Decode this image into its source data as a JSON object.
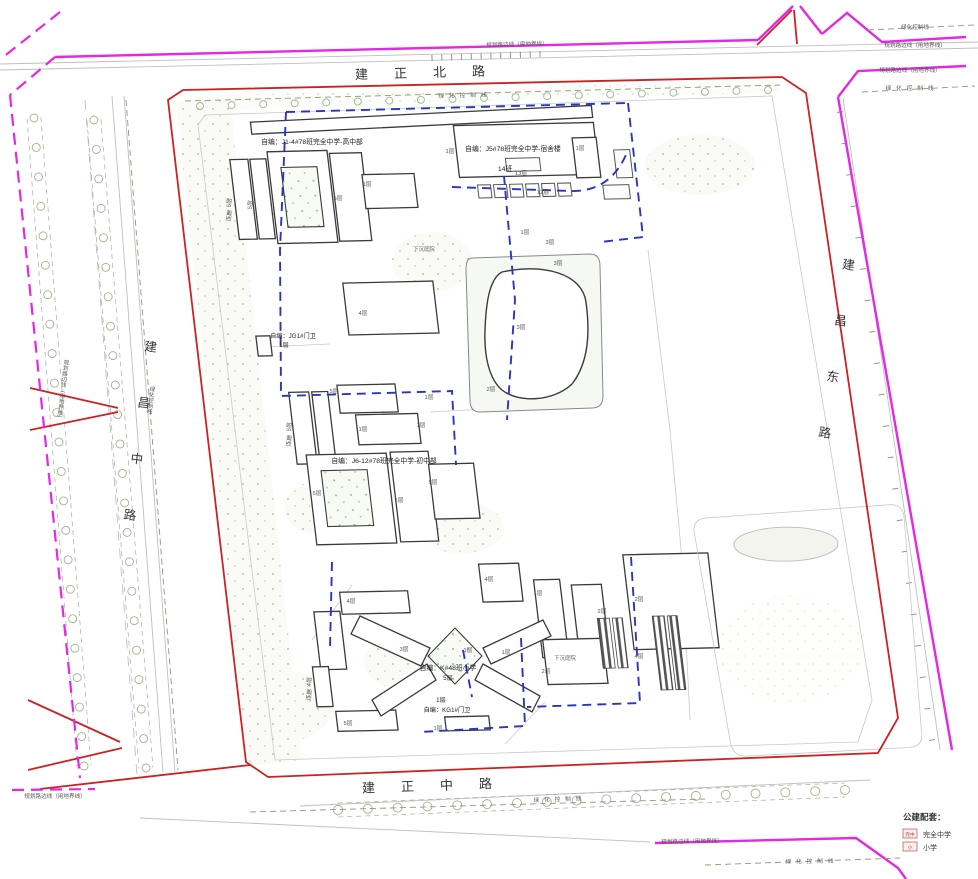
{
  "roads": {
    "north": "建正北路",
    "south": "建正中路",
    "west": "建昌中路",
    "east": "建昌东路"
  },
  "blocks": {
    "high_school": "自编：J1-4#78班完全中学-高中部",
    "dormitory": "自编：J5#78班完全中学-宿舍楼",
    "dormitory_classes": "14班",
    "gate_jg1": "自编：JG1#门卫",
    "gate_jg1_floors": "1层",
    "middle_school": "自编：J6-12#78班完全中学-初中部",
    "primary_school": "自编：K#48班小学",
    "primary_school_floors": "5层",
    "gate_kg1": "自编：KG1#门卫",
    "gate_kg1_floors": "1层",
    "sunken_courtyard": "下沉庭院"
  },
  "line_labels": {
    "planning_edge": "规划路边线（用地界线）",
    "green_control": "绿化控制线"
  },
  "legend": {
    "title": "公建配套：",
    "items": [
      {
        "icon": "完中",
        "label": "完全中学"
      },
      {
        "icon": "小",
        "label": "小学"
      }
    ]
  },
  "floor_tags": [
    {
      "label": "5层"
    },
    {
      "label": "连廊"
    },
    {
      "label": "5层"
    },
    {
      "label": "5层"
    },
    {
      "label": "1层"
    },
    {
      "label": "1层"
    },
    {
      "label": "1层"
    },
    {
      "label": "13层"
    },
    {
      "label": "12层"
    },
    {
      "label": "1层"
    },
    {
      "label": "3层"
    },
    {
      "label": "3层"
    },
    {
      "label": "3层"
    },
    {
      "label": "4层"
    },
    {
      "label": "1层"
    },
    {
      "label": "2层"
    },
    {
      "label": "5层"
    },
    {
      "label": "5层"
    },
    {
      "label": "连廊"
    },
    {
      "label": "1层"
    },
    {
      "label": "1层"
    },
    {
      "label": "5层"
    },
    {
      "label": "1层"
    },
    {
      "label": "5层"
    },
    {
      "label": "4层"
    },
    {
      "label": "4层"
    },
    {
      "label": "1层"
    },
    {
      "label": "2层"
    },
    {
      "label": "2层"
    },
    {
      "label": "4层"
    },
    {
      "label": "3层"
    },
    {
      "label": "1层"
    },
    {
      "label": "1层"
    },
    {
      "label": "5层"
    },
    {
      "label": "1层"
    },
    {
      "label": "4层"
    },
    {
      "label": "连廊"
    },
    {
      "label": "2层"
    }
  ],
  "colors": {
    "boundary_red": "#cc2222",
    "planning_magenta": "#e428e4",
    "parcel_blue": "#2a35c0",
    "building_outline": "#3a3a3a",
    "green_dots": "#9db887"
  }
}
